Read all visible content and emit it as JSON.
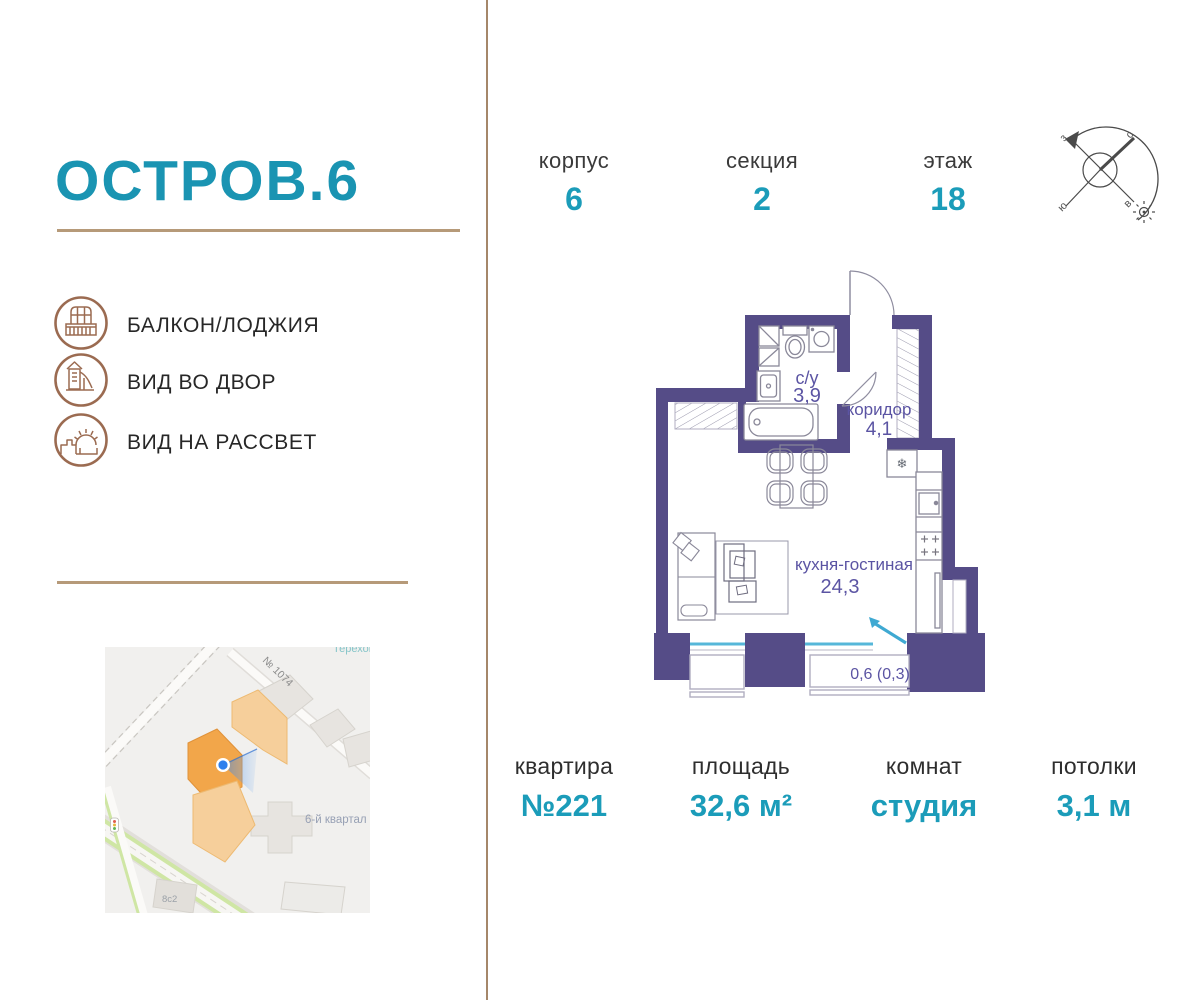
{
  "brand": {
    "logo": "ОСТРОВ.6"
  },
  "features": [
    {
      "icon": "balcony-icon",
      "label": "БАЛКОН/ЛОДЖИЯ"
    },
    {
      "icon": "playground-icon",
      "label": "ВИД ВО ДВОР"
    },
    {
      "icon": "sunrise-icon",
      "label": "ВИД НА РАССВЕТ"
    }
  ],
  "header_stats": [
    {
      "label": "корпус",
      "value": "6"
    },
    {
      "label": "секция",
      "value": "2"
    },
    {
      "label": "этаж",
      "value": "18"
    }
  ],
  "compass": {
    "west": "з",
    "north": "с",
    "south": "ю",
    "east": "в"
  },
  "floorplan": {
    "rooms": [
      {
        "name": "с/у",
        "area": "3,9"
      },
      {
        "name": "коридор",
        "area": "4,1"
      },
      {
        "name": "кухня-гостиная",
        "area": "24,3"
      },
      {
        "name": "балкон",
        "area": "0,6 (0,3)"
      }
    ],
    "fridge_symbol": "❄"
  },
  "map": {
    "street_label": "№ 1074",
    "district_label": "6-й квартал",
    "building_label": "8с2",
    "area_label": "Терехово"
  },
  "footer_stats": [
    {
      "label": "квартира",
      "value": "№221"
    },
    {
      "label": "площадь",
      "value": "32,6 м²"
    },
    {
      "label": "комнат",
      "value": "студия"
    },
    {
      "label": "потолки",
      "value": "3,1 м"
    }
  ],
  "colors": {
    "accent_teal": "#1b9cb9",
    "logo_teal": "#1a94b2",
    "wall_purple": "#554c87",
    "plan_label_purple": "#5b54a3",
    "window_teal": "#56b7d9",
    "tan_line": "#b69a79",
    "icon_brown": "#9b6b51",
    "map_building_orange": "#f6cf9b",
    "map_building_orange_dark": "#f2a64a",
    "marker_blue": "#2f80ed"
  }
}
